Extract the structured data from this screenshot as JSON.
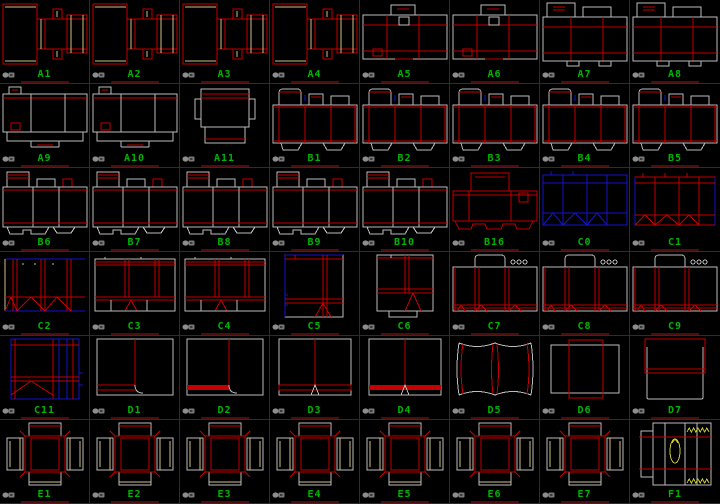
{
  "app": {
    "description": "CAD packaging dieline template palette",
    "background": "#000000",
    "grid": {
      "rows": 6,
      "cols": 8
    },
    "label_color": "#00b400",
    "separator_color": "#2d2d2d",
    "underline_color": "#4d0d0d"
  },
  "palette": {
    "red": "#c40000",
    "khaki": "#cfc08a",
    "gray": "#bdbdbd",
    "blue": "#1414cc",
    "yellow": "#c8c832",
    "icon_gray": "#8d8d8d"
  },
  "icons": {
    "cell_icon": "block-icon"
  },
  "cells": [
    {
      "label": "A1",
      "kind": "sleeveKhaki"
    },
    {
      "label": "A2",
      "kind": "sleeveKhaki"
    },
    {
      "label": "A3",
      "kind": "sleeveKhaki"
    },
    {
      "label": "A4",
      "kind": "sleeveKhaki"
    },
    {
      "label": "A5",
      "kind": "trayWide"
    },
    {
      "label": "A6",
      "kind": "trayWide"
    },
    {
      "label": "A7",
      "kind": "trayWide2"
    },
    {
      "label": "A8",
      "kind": "trayWide2"
    },
    {
      "label": "A9",
      "kind": "bigTray"
    },
    {
      "label": "A10",
      "kind": "bigTray"
    },
    {
      "label": "A11",
      "kind": "lidTop"
    },
    {
      "label": "B1",
      "kind": "tuckCarton"
    },
    {
      "label": "B2",
      "kind": "tuckCarton"
    },
    {
      "label": "B3",
      "kind": "tuckCarton"
    },
    {
      "label": "B4",
      "kind": "tuckCarton"
    },
    {
      "label": "B5",
      "kind": "tuckCarton"
    },
    {
      "label": "B6",
      "kind": "carton2"
    },
    {
      "label": "B7",
      "kind": "carton2"
    },
    {
      "label": "B8",
      "kind": "carton2"
    },
    {
      "label": "B9",
      "kind": "carton2"
    },
    {
      "label": "B10",
      "kind": "carton2"
    },
    {
      "label": "B16",
      "kind": "cartonRed"
    },
    {
      "label": "C0",
      "kind": "blueCrash"
    },
    {
      "label": "C1",
      "kind": "redCrash"
    },
    {
      "label": "C2",
      "kind": "redCrash2"
    },
    {
      "label": "C3",
      "kind": "crashLock"
    },
    {
      "label": "C4",
      "kind": "crashLock"
    },
    {
      "label": "C5",
      "kind": "tallCrash"
    },
    {
      "label": "C6",
      "kind": "tallCrash2"
    },
    {
      "label": "C7",
      "kind": "displayBox"
    },
    {
      "label": "C8",
      "kind": "displayBox"
    },
    {
      "label": "C9",
      "kind": "displayBox"
    },
    {
      "label": "C11",
      "kind": "blueTall"
    },
    {
      "label": "D1",
      "kind": "wrapL1"
    },
    {
      "label": "D2",
      "kind": "wrapL2"
    },
    {
      "label": "D3",
      "kind": "wrapT1"
    },
    {
      "label": "D4",
      "kind": "wrapT2"
    },
    {
      "label": "D5",
      "kind": "pillow"
    },
    {
      "label": "D6",
      "kind": "overlap"
    },
    {
      "label": "D7",
      "kind": "sleeve2"
    },
    {
      "label": "E1",
      "kind": "crossTray"
    },
    {
      "label": "E2",
      "kind": "crossTray"
    },
    {
      "label": "E3",
      "kind": "crossTray"
    },
    {
      "label": "E4",
      "kind": "crossTray"
    },
    {
      "label": "E5",
      "kind": "crossTray"
    },
    {
      "label": "E6",
      "kind": "crossTray"
    },
    {
      "label": "E7",
      "kind": "crossTray"
    },
    {
      "label": "F1",
      "kind": "ovalStrip"
    }
  ]
}
